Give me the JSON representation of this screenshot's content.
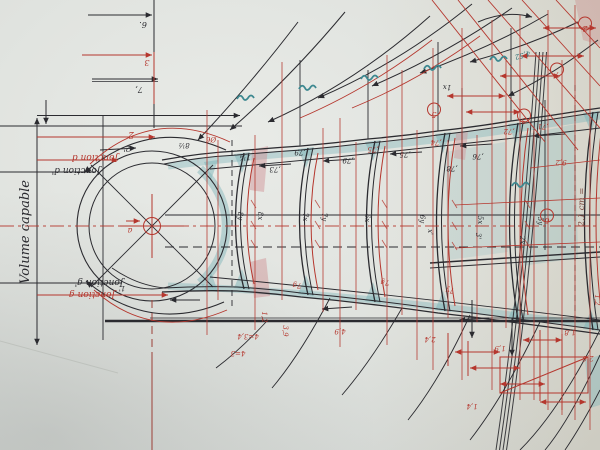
{
  "labels": {
    "volume_capable": "Volume capable",
    "jonction_d": "Jonction d",
    "jonction_d_prime": "Jonction d'",
    "jonction_g": "Jonction g",
    "jonction_g_prime": "Jonction g'",
    "scale_note": "2,1 cm ="
  },
  "colors": {
    "paper": "#dfe2de",
    "k": "#2b2b30",
    "r": "#b5372e",
    "t": "#2e6d74",
    "b": "#7a4a40",
    "teal_wash": "#7db4b8",
    "pink_wash": "#cf8f93",
    "pencil": "#b4b8b2"
  },
  "annotations": [
    {
      "t": "6.",
      "x": 143,
      "y": 22,
      "c": "k",
      "r": 180,
      "s": 8
    },
    {
      "t": "3",
      "x": 147,
      "y": 60,
      "c": "r",
      "r": 180,
      "s": 8
    },
    {
      "t": "7,",
      "x": 139,
      "y": 87,
      "c": "k",
      "r": 180,
      "s": 8
    },
    {
      "t": "2",
      "x": 131,
      "y": 132,
      "c": "r",
      "r": 180,
      "s": 9
    },
    {
      "t": "2'",
      "x": 127,
      "y": 146,
      "c": "k",
      "r": 180,
      "s": 8
    },
    {
      "t": "8½",
      "x": 184,
      "y": 143,
      "c": "k",
      "r": 180,
      "s": 7
    },
    {
      "t": "Ø6",
      "x": 211,
      "y": 137,
      "c": "r",
      "r": 180,
      "s": 7
    },
    {
      "t": "a",
      "x": 130,
      "y": 228,
      "c": "r",
      "r": 180,
      "s": 8
    },
    {
      "t": "1'",
      "x": 122,
      "y": 286,
      "c": "k",
      "r": 180,
      "s": 7
    },
    {
      "t": "1¼",
      "x": 245,
      "y": 155,
      "c": "k",
      "r": 180,
      "s": 7
    },
    {
      "t": "8y",
      "x": 238,
      "y": 216,
      "c": "k",
      "r": 90,
      "s": 7
    },
    {
      "t": "8x",
      "x": 258,
      "y": 216,
      "c": "k",
      "r": 90,
      "s": 7
    },
    {
      "t": "7x",
      "x": 303,
      "y": 217,
      "c": "k",
      "r": 90,
      "s": 7
    },
    {
      "t": "7y",
      "x": 322,
      "y": 217,
      "c": "k",
      "r": 90,
      "s": 7
    },
    {
      "t": "6x",
      "x": 365,
      "y": 218,
      "c": "k",
      "r": 90,
      "s": 7
    },
    {
      "t": "6y",
      "x": 420,
      "y": 219,
      "c": "k",
      "r": 90,
      "s": 7
    },
    {
      "t": "5x",
      "x": 478,
      "y": 220,
      "c": "k",
      "r": 90,
      "s": 7
    },
    {
      "t": "5y",
      "x": 538,
      "y": 221,
      "c": "k",
      "r": 90,
      "s": 7
    },
    {
      "t": ",73",
      "x": 275,
      "y": 167,
      "c": "k",
      "r": 180,
      "s": 7
    },
    {
      "t": ",79",
      "x": 348,
      "y": 158,
      "c": "k",
      "r": 180,
      "s": 7
    },
    {
      "t": ",79",
      "x": 300,
      "y": 150,
      "c": "k",
      "r": 180,
      "s": 7
    },
    {
      "t": ",75",
      "x": 373,
      "y": 147,
      "c": "r",
      "r": 180,
      "s": 7
    },
    {
      "t": ",75",
      "x": 405,
      "y": 152,
      "c": "k",
      "r": 180,
      "s": 7
    },
    {
      "t": ",74",
      "x": 436,
      "y": 140,
      "c": "r",
      "r": 180,
      "s": 7
    },
    {
      "t": ",76",
      "x": 478,
      "y": 154,
      "c": "k",
      "r": 180,
      "s": 7
    },
    {
      "t": ",78",
      "x": 452,
      "y": 166,
      "c": "k",
      "r": 180,
      "s": 7
    },
    {
      "t": ",72",
      "x": 509,
      "y": 129,
      "c": "r",
      "r": 180,
      "s": 7
    },
    {
      "t": ",71",
      "x": 543,
      "y": 124,
      "c": "r",
      "r": 180,
      "s": 7
    },
    {
      "t": "1x",
      "x": 447,
      "y": 85,
      "c": "k",
      "r": 180,
      "s": 7
    },
    {
      "t": "4,52",
      "x": 522,
      "y": 53,
      "c": "t",
      "r": 165,
      "s": 7
    },
    {
      "t": "9,2",
      "x": 561,
      "y": 160,
      "c": "r",
      "r": 180,
      "s": 7
    },
    {
      "t": "x'",
      "x": 428,
      "y": 232,
      "c": "k",
      "r": 90,
      "s": 7
    },
    {
      "t": "3'",
      "x": 476,
      "y": 236,
      "c": "k",
      "r": 90,
      "s": 7
    },
    {
      "t": "2x",
      "x": 520,
      "y": 240,
      "c": "k",
      "r": 90,
      "s": 7
    },
    {
      "t": "7g",
      "x": 297,
      "y": 283,
      "c": "r",
      "r": 180,
      "s": 7
    },
    {
      "t": "7g",
      "x": 385,
      "y": 280,
      "c": "r",
      "r": 180,
      "s": 7
    },
    {
      "t": "7y",
      "x": 450,
      "y": 288,
      "c": "r",
      "r": 180,
      "s": 7
    },
    {
      "t": "1,2",
      "x": 262,
      "y": 317,
      "c": "r",
      "r": 90,
      "s": 7
    },
    {
      "t": "3,9",
      "x": 283,
      "y": 331,
      "c": "r",
      "r": 90,
      "s": 7
    },
    {
      "t": "4,9",
      "x": 340,
      "y": 329,
      "c": "r",
      "r": 180,
      "s": 7
    },
    {
      "t": "4=3,4",
      "x": 248,
      "y": 334,
      "c": "r",
      "r": 180,
      "s": 7
    },
    {
      "t": "4=3",
      "x": 238,
      "y": 351,
      "c": "r",
      "r": 180,
      "s": 7
    },
    {
      "t": "2,4",
      "x": 430,
      "y": 337,
      "c": "r",
      "r": 180,
      "s": 7
    },
    {
      "t": "1,9",
      "x": 500,
      "y": 346,
      "c": "r",
      "r": 180,
      "s": 7
    },
    {
      "t": "1,4",
      "x": 472,
      "y": 404,
      "c": "r",
      "r": 180,
      "s": 7
    },
    {
      "t": "2,6",
      "x": 588,
      "y": 356,
      "c": "r",
      "r": 180,
      "s": 7
    },
    {
      "t": "1,8",
      "x": 570,
      "y": 330,
      "c": "r",
      "r": 180,
      "s": 7
    },
    {
      "t": "1,2",
      "x": 595,
      "y": 300,
      "c": "r",
      "r": 90,
      "s": 7
    },
    {
      "t": "5",
      "x": 434,
      "y": 112,
      "c": "r",
      "r": 180,
      "s": 8,
      "circled": true
    },
    {
      "t": "3",
      "x": 524,
      "y": 118,
      "c": "r",
      "r": 180,
      "s": 8,
      "circled": true
    },
    {
      "t": "7",
      "x": 557,
      "y": 72,
      "c": "r",
      "r": 180,
      "s": 8,
      "circled": true
    },
    {
      "t": "6",
      "x": 547,
      "y": 218,
      "c": "r",
      "r": 180,
      "s": 8,
      "circled": true
    },
    {
      "t": "2",
      "x": 585,
      "y": 26,
      "c": "r",
      "r": 180,
      "s": 8,
      "circled": true
    }
  ]
}
